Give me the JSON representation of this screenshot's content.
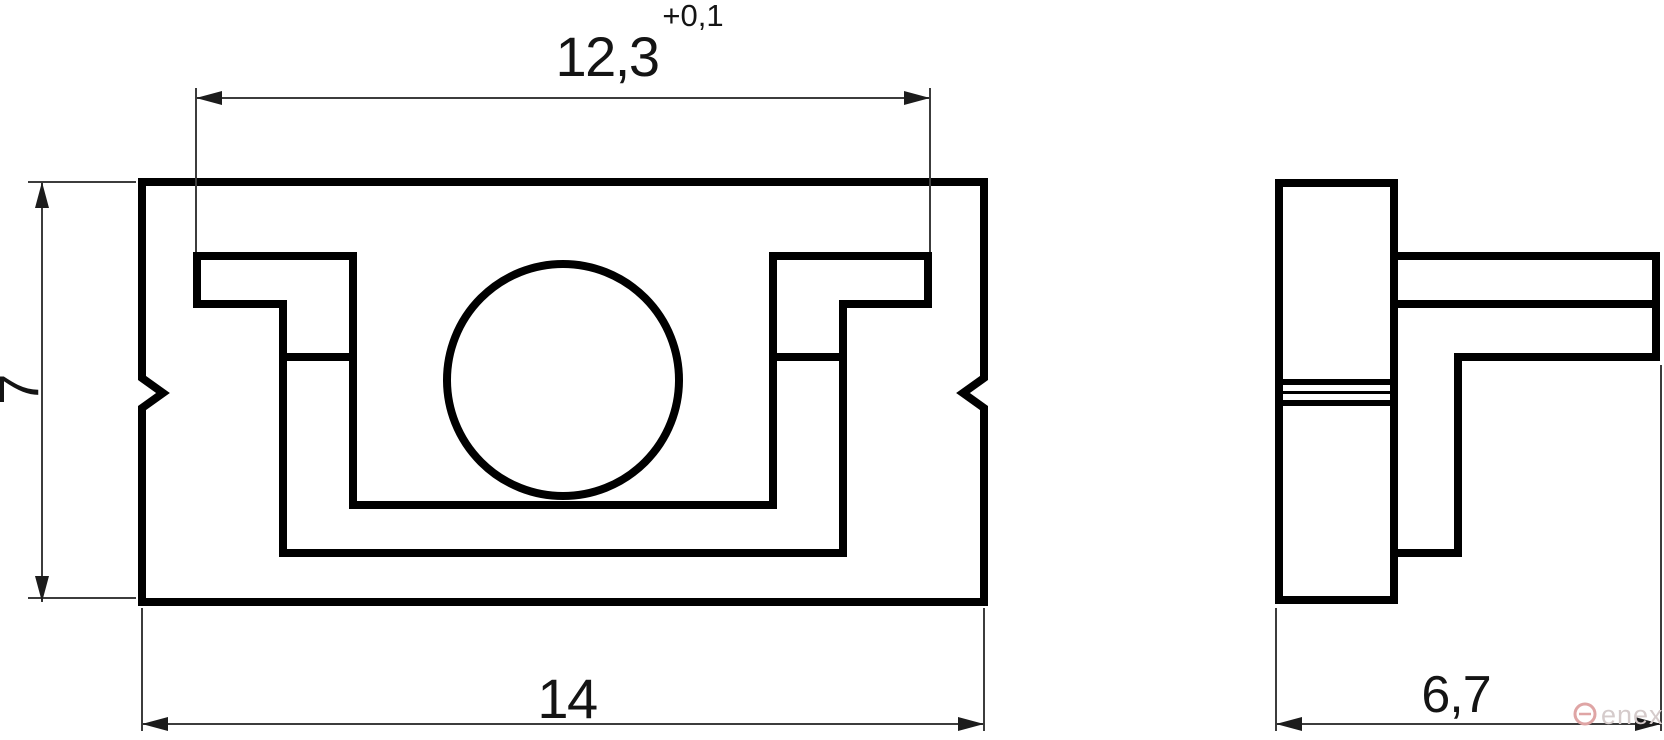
{
  "drawing": {
    "description": "two-view technical drawing of a slotted mount block with central hole",
    "views": {
      "front_view": "front-view",
      "side_view": "side-view"
    },
    "dimensions": {
      "slot_width_top": {
        "value": "12,3",
        "tolerance": "+0,1"
      },
      "height_left": {
        "value": "7"
      },
      "overall_width_bottom": {
        "value": "14"
      },
      "depth_side": {
        "value": "6,7"
      }
    },
    "watermark": {
      "text": "enex"
    },
    "colors": {
      "background": "#ffffff",
      "part_line": "#000000",
      "dimension_line": "#3c3c3c",
      "label_text": "#141414",
      "watermark_logo": "#dfa5a5",
      "watermark_text": "#d5cbcb"
    }
  }
}
